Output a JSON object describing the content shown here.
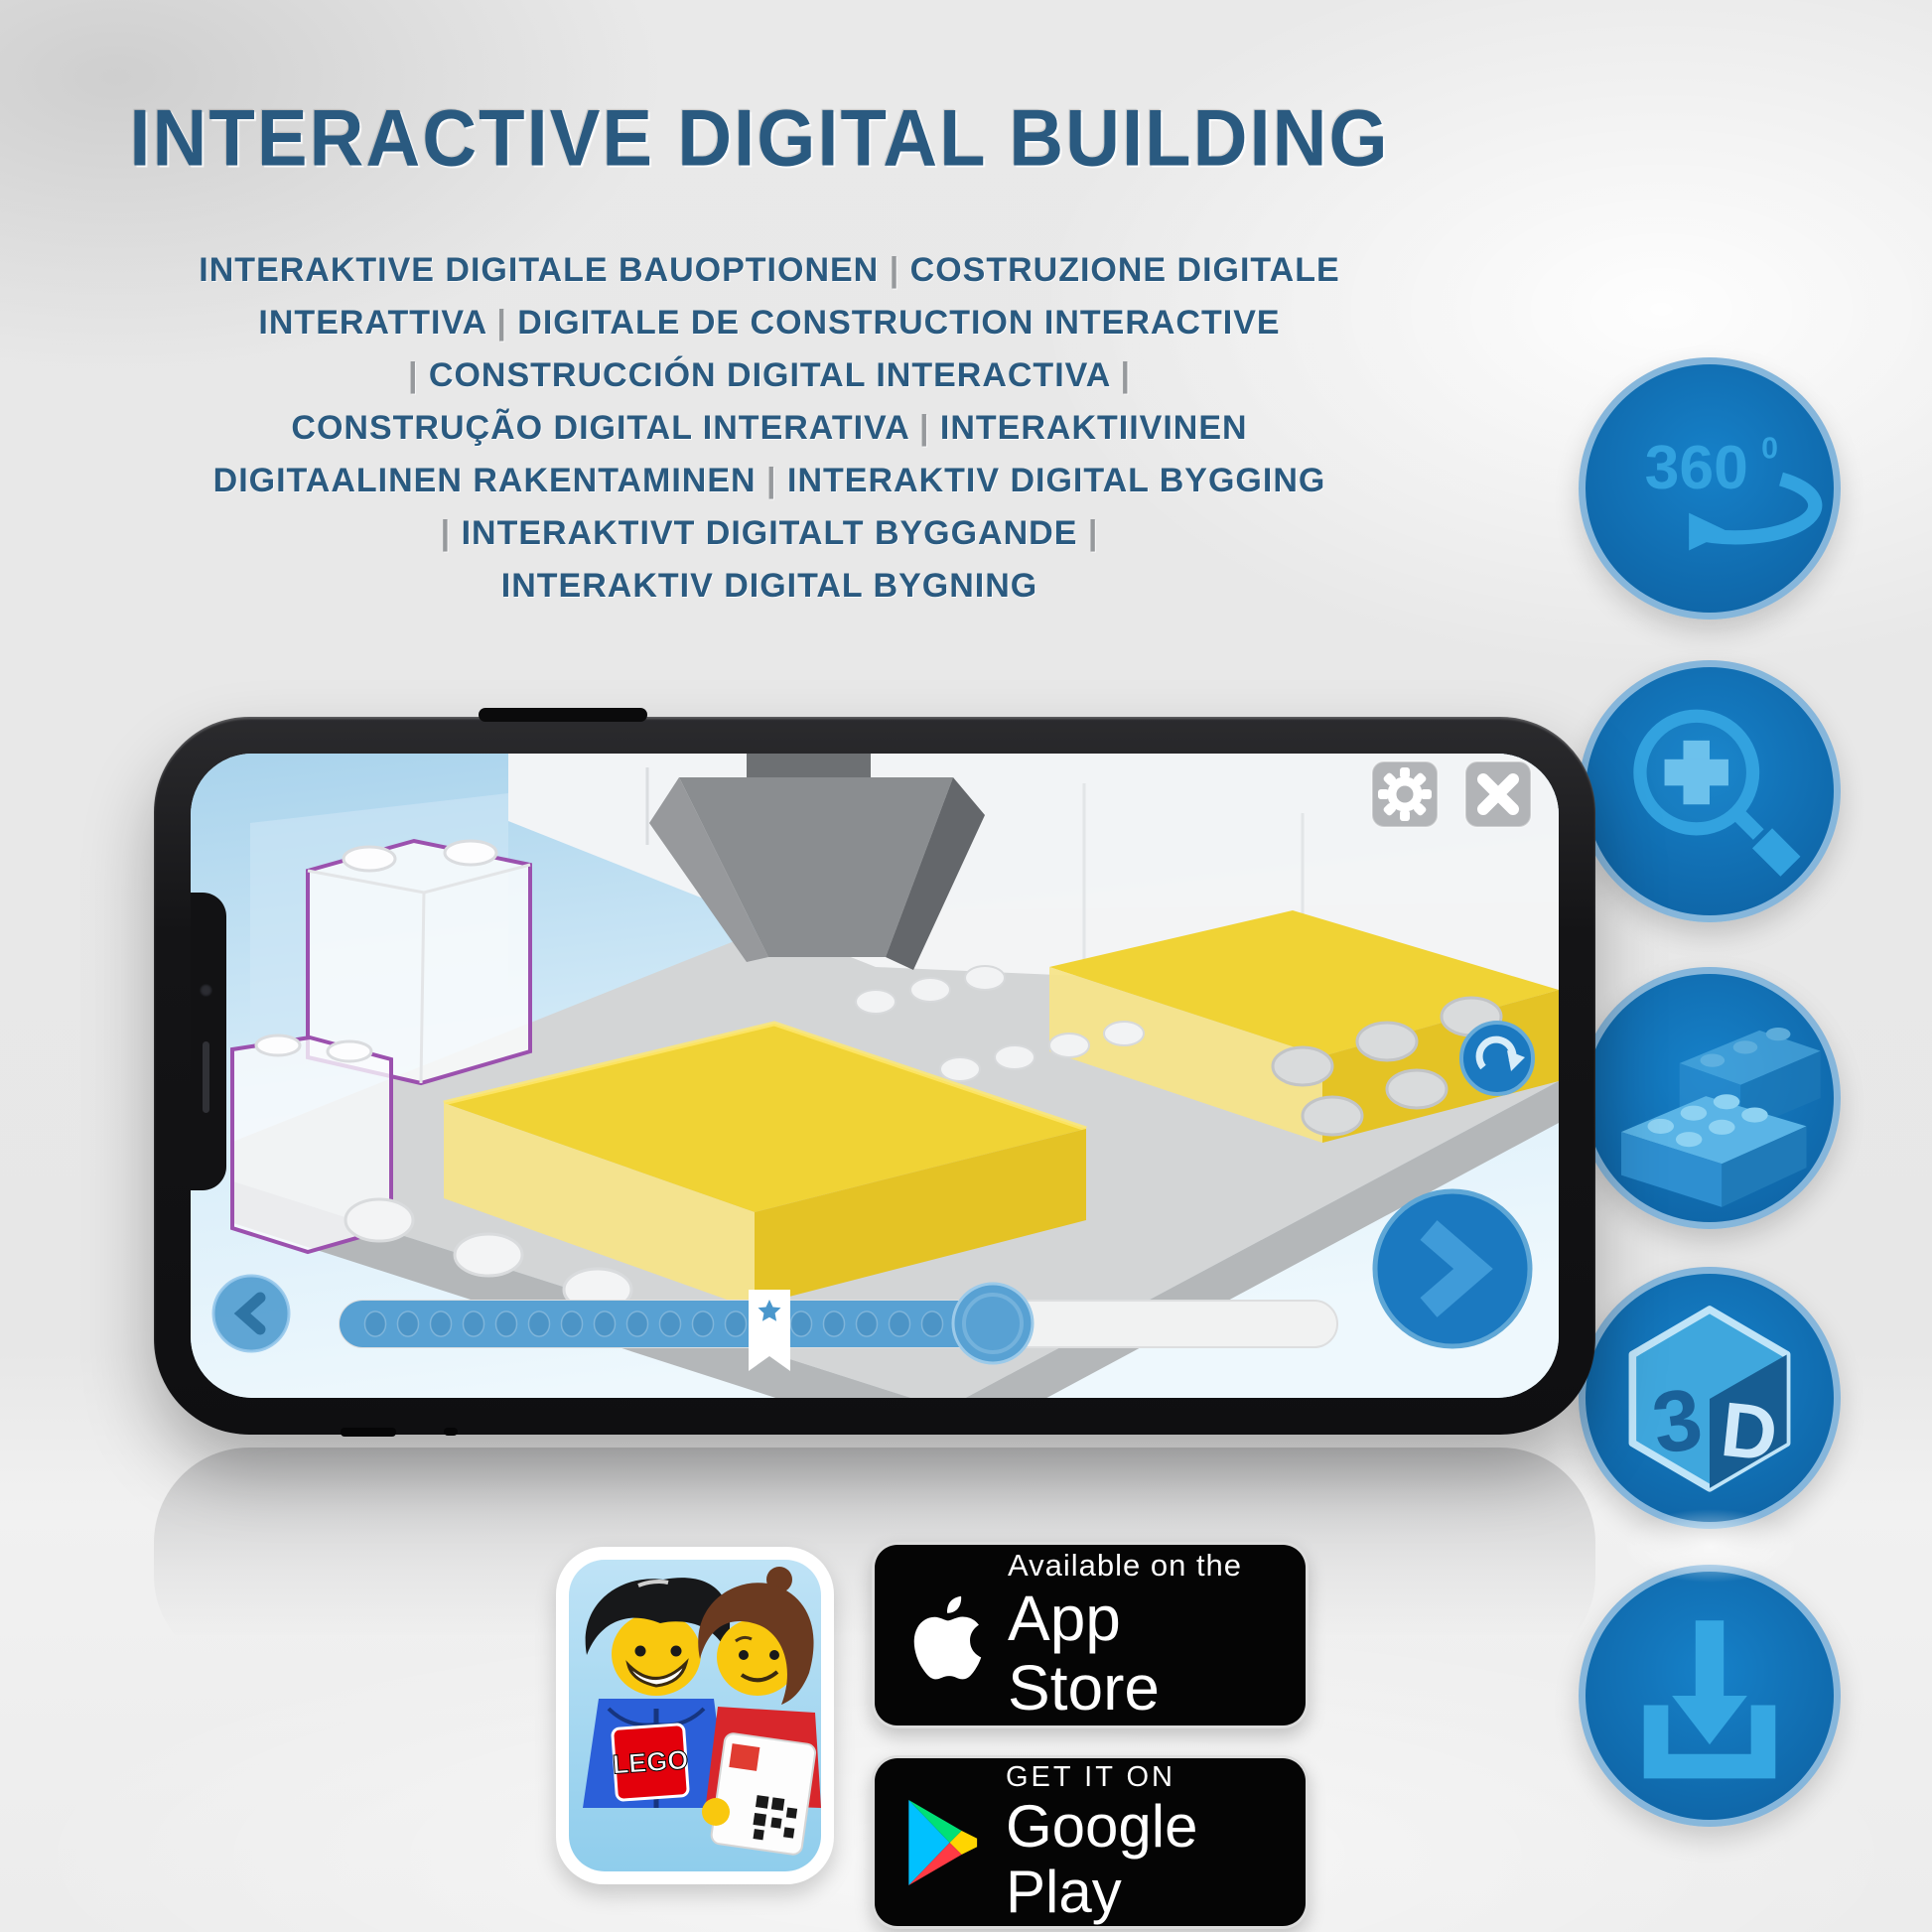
{
  "title": "INTERACTIVE DIGITAL BUILDING",
  "subtitle_lines": [
    "INTERAKTIVE DIGITALE BAUOPTIONEN | COSTRUZIONE DIGITALE",
    "INTERATTIVA | DIGITALE DE CONSTRUCTION INTERACTIVE",
    "| CONSTRUCCIÓN DIGITAL INTERACTIVA |",
    "CONSTRUÇÃO DIGITAL INTERATIVA | INTERAKTIIVINEN",
    "DIGITAALINEN RAKENTAMINEN | INTERAKTIV DIGITAL BYGGING",
    "| INTERAKTIVT DIGITALT BYGGANDE |",
    "INTERAKTIV DIGITAL BYGNING"
  ],
  "feature_icons": {
    "rotation_360": {
      "name": "360-rotation",
      "label_number": "360",
      "label_degree": "0"
    },
    "zoom": {
      "name": "zoom-in"
    },
    "brick": {
      "name": "brick-building"
    },
    "cube_3d": {
      "name": "3d-view",
      "left_letter": "3",
      "right_letter": "D"
    },
    "download": {
      "name": "download"
    }
  },
  "phone_app": {
    "top_buttons": {
      "settings": "gear",
      "close": "x"
    },
    "controls": {
      "rotate": "rotate-arrow",
      "next": "chevron-right",
      "previous": "chevron-left"
    },
    "progress_bar": {
      "bookmark": "star",
      "dots_visible": 18,
      "knob": true,
      "filled_ratio": 0.66
    }
  },
  "store_badges": {
    "app_store": {
      "line1": "Available on the",
      "line2": "App Store"
    },
    "google_play": {
      "line1": "GET IT ON",
      "line2": "Google Play"
    }
  },
  "lego_app_icon": {
    "logo_text": "LEGO"
  },
  "colors": {
    "headline_blue": "#2a5a80",
    "icon_circle_blue": "#1173b8",
    "icon_glyph_blue": "#32a2df",
    "phone_ui_blue": "#1b79c0",
    "progress_fill_blue": "#58a1d3",
    "brick_yellow": "#f0d335",
    "outline_purple": "#9b51ae",
    "badge_black": "#050505"
  }
}
